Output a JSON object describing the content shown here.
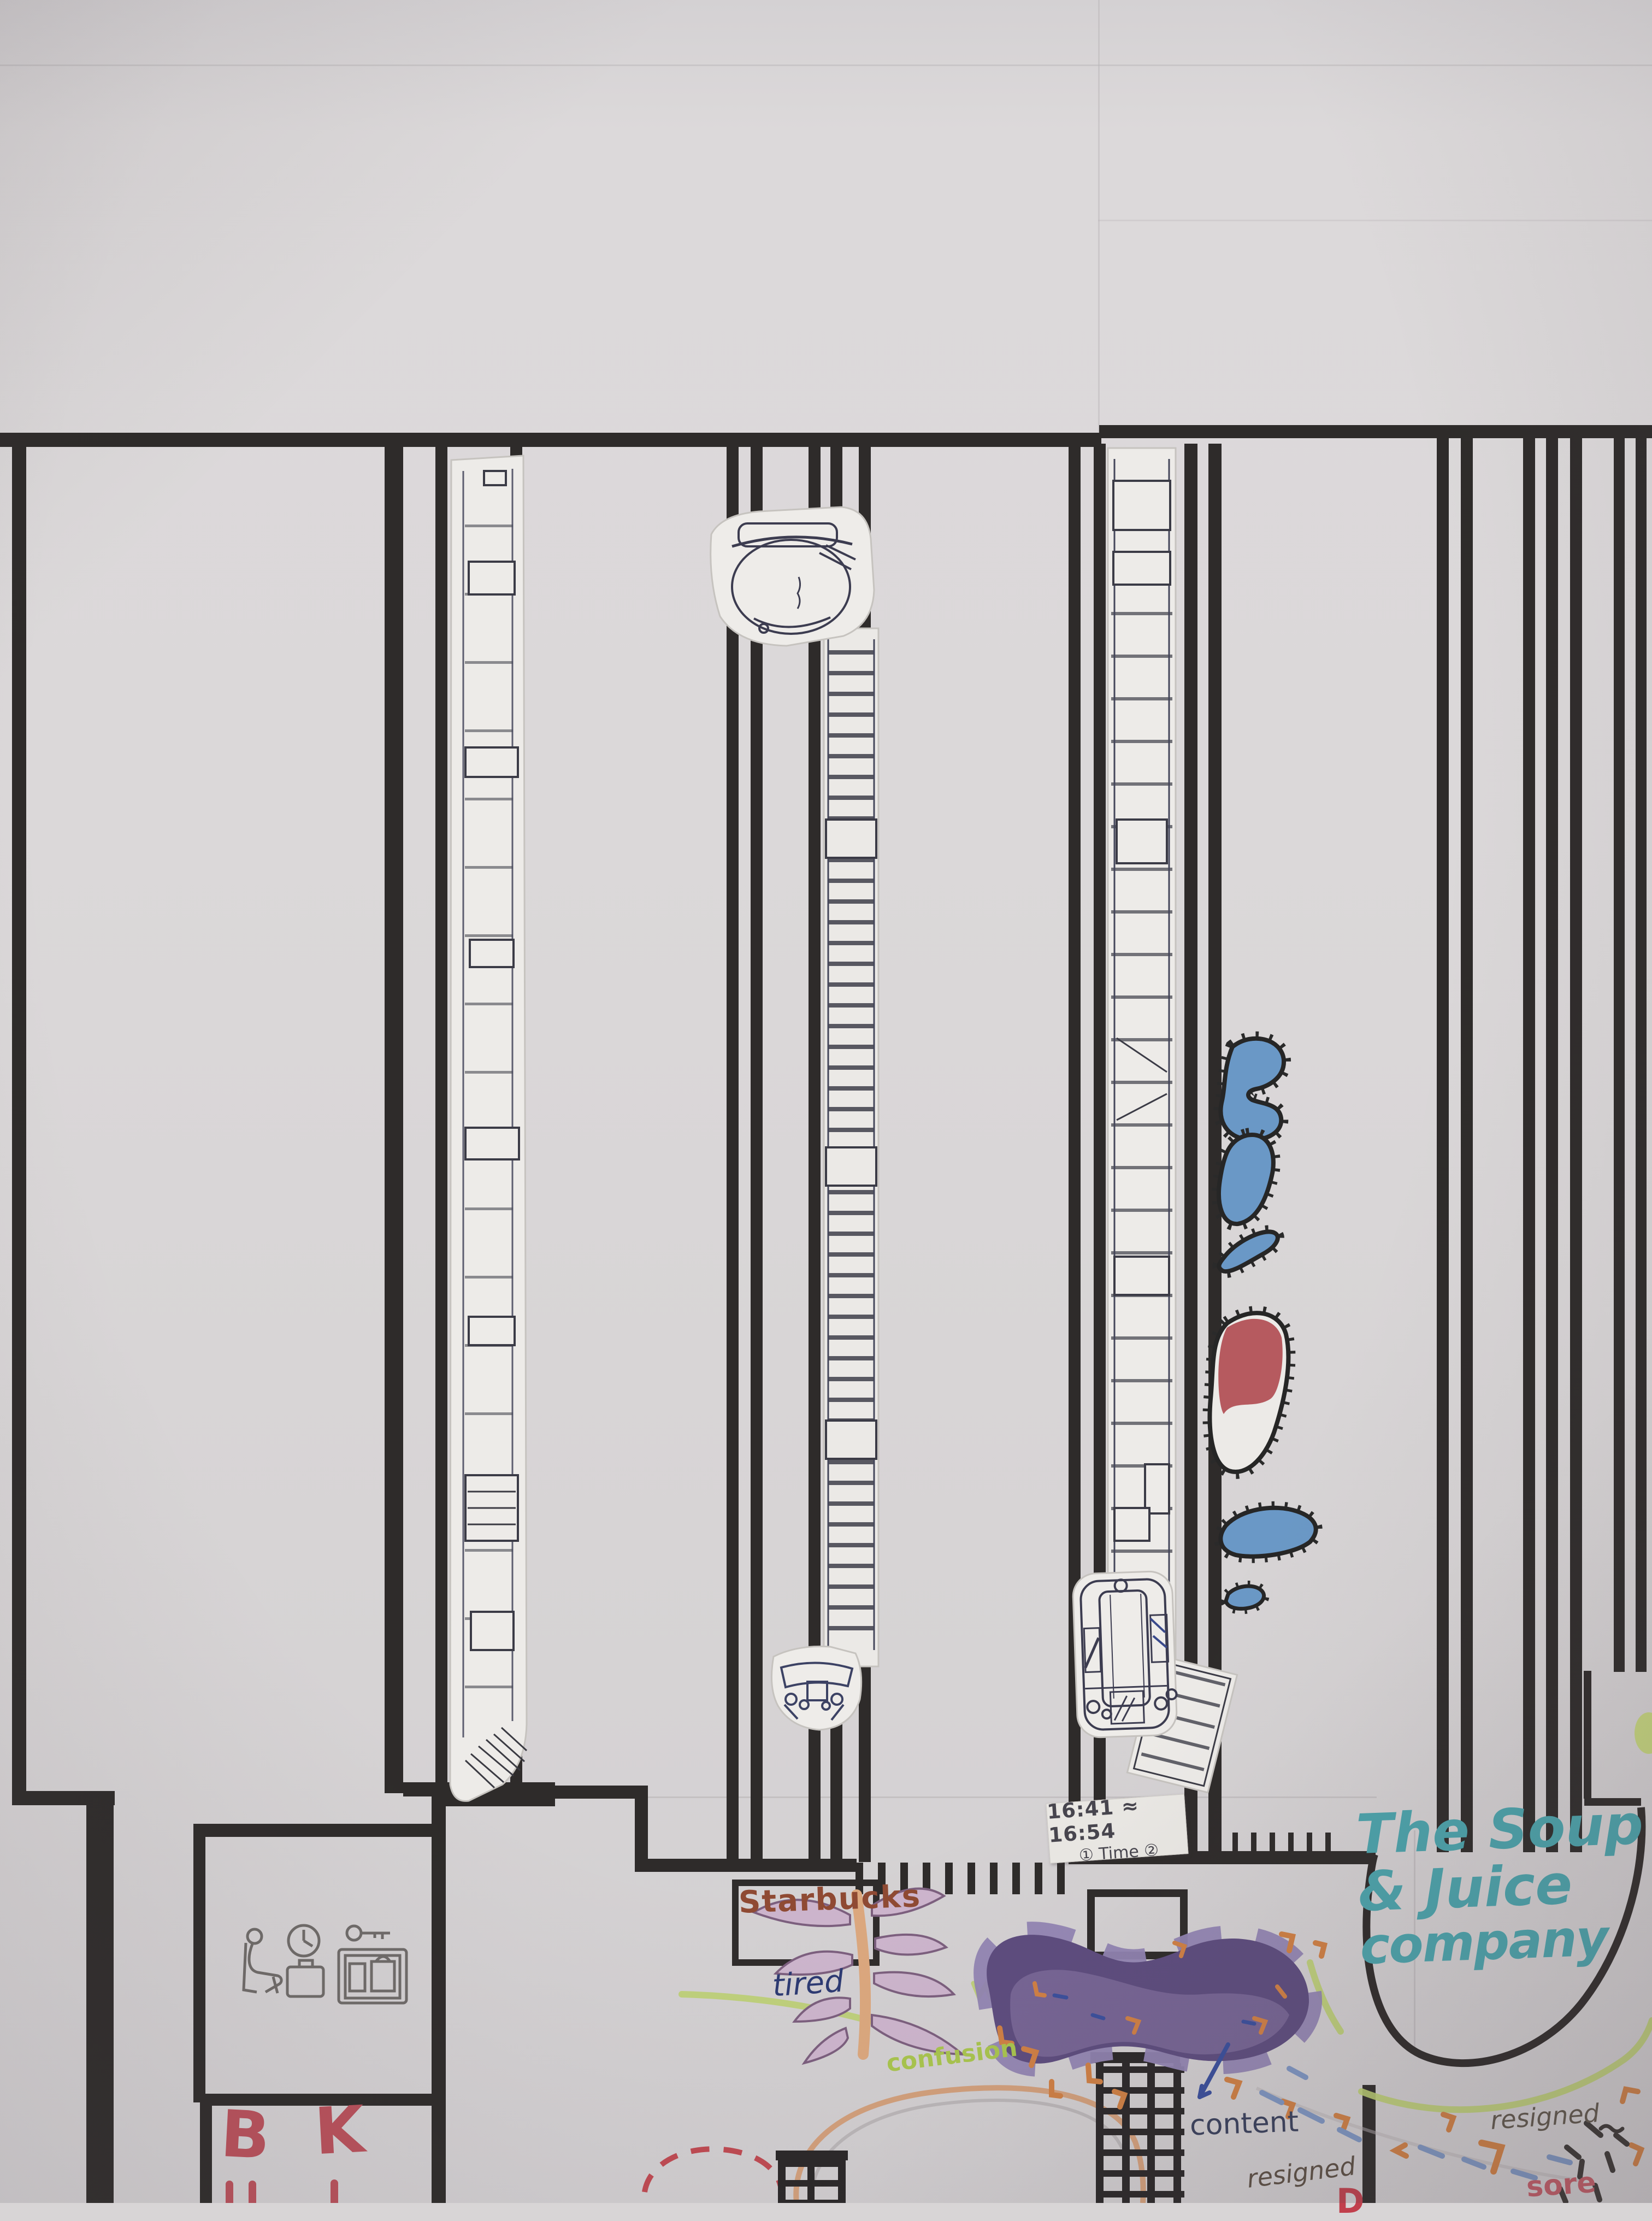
{
  "sticky_note": {
    "line1": "16:41 ≈ 16:54",
    "line2": "① Time ②"
  },
  "shops": {
    "starbucks": "Starbucks",
    "soup_juice": {
      "line1": "The Soup",
      "line2": "& Juice",
      "line3": "company"
    },
    "burger_king": {
      "letter1": "B",
      "letter2": "K"
    }
  },
  "emotions": {
    "tired": "tired",
    "confusion": "confusion",
    "content": "content",
    "resigned_center": "resigned",
    "resigned_right": "resigned",
    "sore": "sore",
    "partial_red_text": "D"
  },
  "icons": [
    {
      "name": "seated-person-icon"
    },
    {
      "name": "clock-icon"
    },
    {
      "name": "briefcase-icon"
    },
    {
      "name": "key-icon"
    },
    {
      "name": "luggage-locker-icon"
    }
  ],
  "colors": {
    "paper": "#d8d5d6",
    "tape": "#2e2b2a",
    "teal": "#4ba4ac",
    "red_letters": "#b8505a",
    "brown": "#8f4a33",
    "navy": "#2c3a72",
    "lime": "#a9c54e",
    "ink": "#39405c",
    "gray_brown": "#5c4f44",
    "rose": "#c25b66",
    "orange": "#d08044",
    "blob_blue": "#6a98c6",
    "blob_red": "#b04a50",
    "purple": "#5d4c7e",
    "green_path": "#bccf72"
  }
}
